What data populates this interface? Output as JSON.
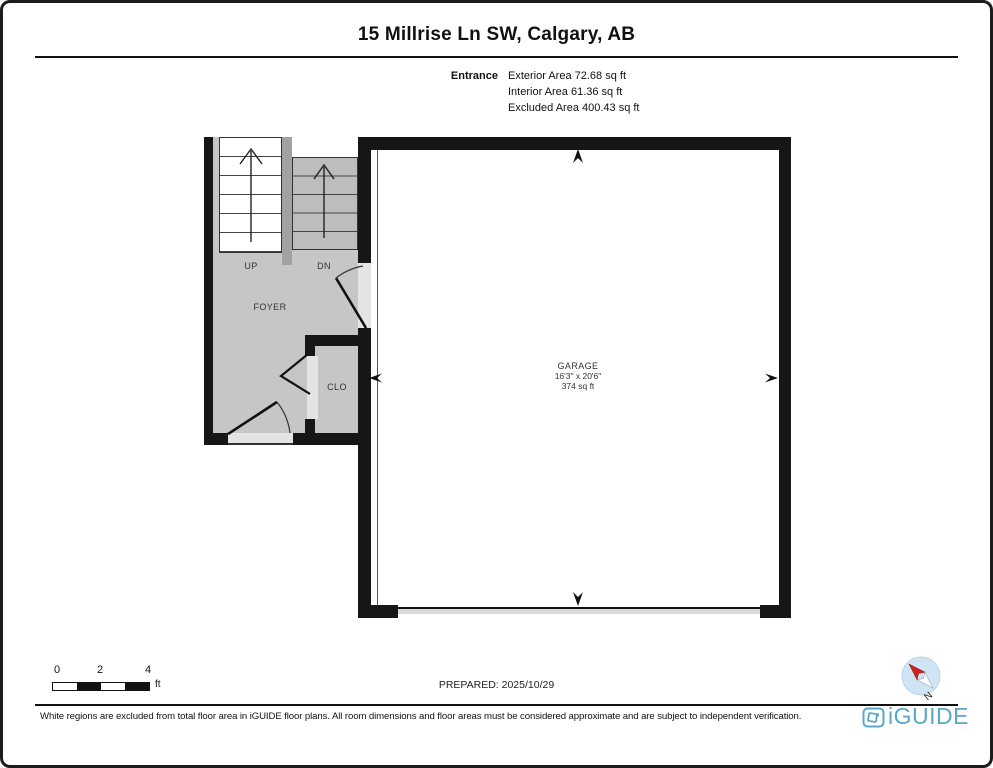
{
  "page": {
    "title": "15 Millrise Ln SW, Calgary, AB"
  },
  "summary": {
    "room_label": "Entrance",
    "lines": [
      "Exterior Area 72.68 sq ft",
      "Interior Area 61.36 sq ft",
      "Excluded Area 400.43 sq ft"
    ]
  },
  "plan": {
    "labels": {
      "up": "UP",
      "dn": "DN",
      "foyer": "FOYER",
      "closet": "CLO"
    },
    "garage": {
      "name": "GARAGE",
      "dimensions": "16'3\" x 20'6\"",
      "area": "374 sq ft"
    }
  },
  "scale_bar": {
    "ticks": [
      "0",
      "2",
      "4"
    ],
    "unit": "ft"
  },
  "prepared": "PREPARED: 2025/10/29",
  "compass": {
    "north_label": "N"
  },
  "footer": {
    "disclaimer": "White regions are excluded from total floor area in iGUIDE floor plans. All room dimensions and floor areas must be considered approximate and are subject to independent verification.",
    "brand": "iGUIDE"
  },
  "colors": {
    "wall": "#161616",
    "floor_gray": "#c6c6c6",
    "stair_dn_gray": "#bdbdbd",
    "divider_gray": "#a2a2a2",
    "opening_light": "#e4e4e4",
    "brand_teal": "#5ba7c7",
    "compass_fill": "#cfe4f4",
    "compass_needle_red": "#cc2222"
  }
}
